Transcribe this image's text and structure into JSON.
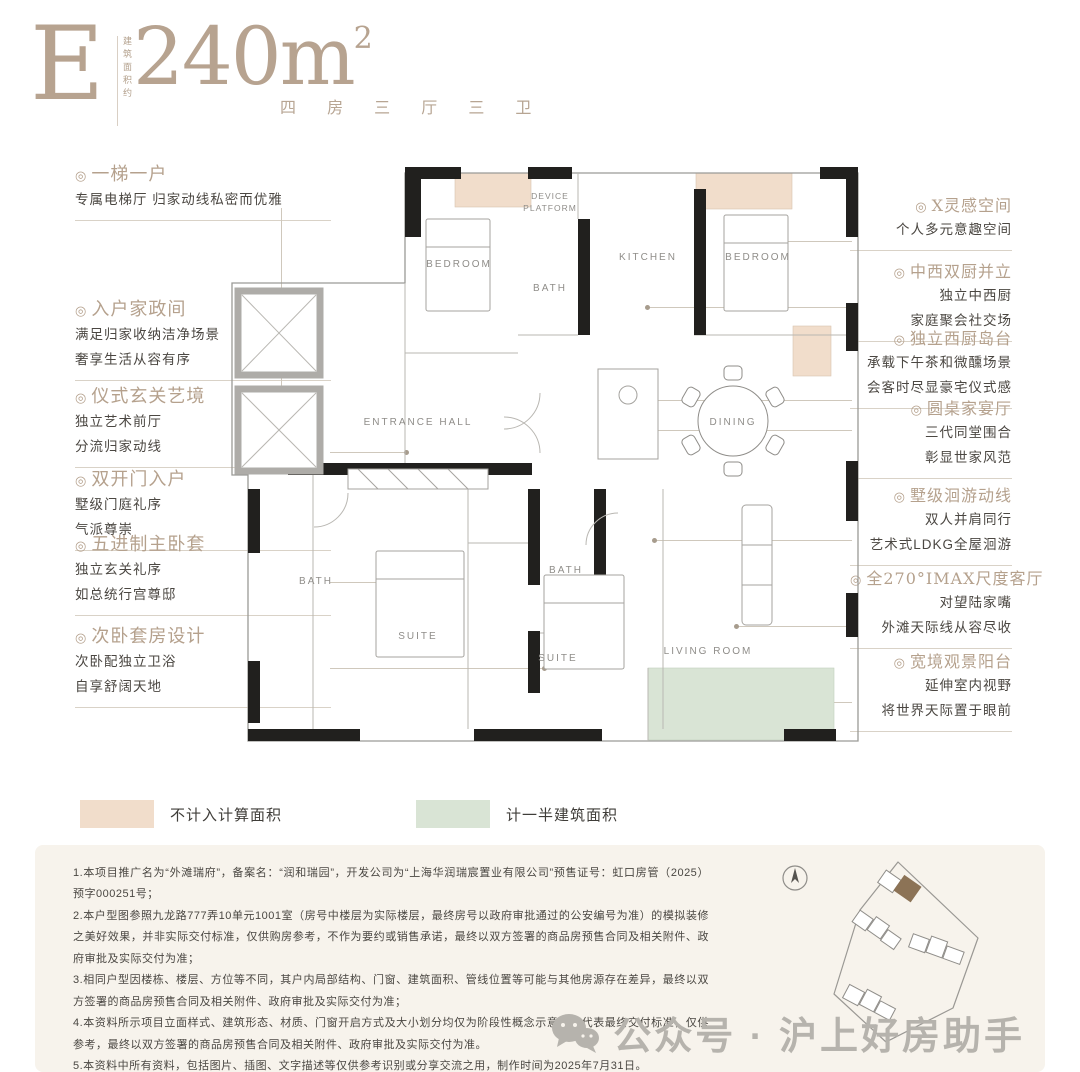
{
  "header": {
    "monogram": "E",
    "area_caption": "建筑面积约",
    "area_value": "240m",
    "area_sup": "2",
    "spec": "四 房 三 厅 三 卫"
  },
  "misc": {
    "bullet": "◎"
  },
  "left_annotations": [
    {
      "title": "一梯一户",
      "lines": [
        "专属电梯厅 归家动线私密而优雅"
      ]
    },
    {
      "title": "入户家政间",
      "lines": [
        "满足归家收纳洁净场景",
        "奢享生活从容有序"
      ]
    },
    {
      "title": "仪式玄关艺境",
      "lines": [
        "独立艺术前厅",
        "分流归家动线"
      ]
    },
    {
      "title": "双开门入户",
      "lines": [
        "墅级门庭礼序",
        "气派尊崇"
      ]
    },
    {
      "title": "五进制主卧套",
      "lines": [
        "独立玄关礼序",
        "如总统行宫尊邸"
      ]
    },
    {
      "title": "次卧套房设计",
      "lines": [
        "次卧配独立卫浴",
        "自享舒阔天地"
      ]
    }
  ],
  "right_annotations": [
    {
      "title": "X灵感空间",
      "lines": [
        "个人多元意趣空间"
      ]
    },
    {
      "title": "中西双厨并立",
      "lines": [
        "独立中西厨",
        "家庭聚会社交场"
      ]
    },
    {
      "title": "独立西厨岛台",
      "lines": [
        "承载下午茶和微醺场景",
        "会客时尽显豪宅仪式感"
      ]
    },
    {
      "title": "圆桌家宴厅",
      "lines": [
        "三代同堂围合",
        "彰显世家风范"
      ]
    },
    {
      "title": "墅级洄游动线",
      "lines": [
        "双人并肩同行",
        "艺术式LDKG全屋洄游"
      ]
    },
    {
      "title": "全270°IMAX尺度客厅",
      "lines": [
        "对望陆家嘴",
        "外滩天际线从容尽收"
      ]
    },
    {
      "title": "宽境观景阳台",
      "lines": [
        "延伸室内视野",
        "将世界天际置于眼前"
      ]
    }
  ],
  "floor_plan": {
    "bedroom_left": "BEDROOM",
    "device_platform_line1": "DEVICE",
    "device_platform_line2": "PLATFORM",
    "bath_top": "BATH",
    "kitchen": "KITCHEN",
    "bedroom_right": "BEDROOM",
    "entrance_hall": "ENTRANCE HALL",
    "dining": "DINING",
    "bath_left": "BATH",
    "suite_main": "SUITE",
    "bath_mid": "BATH",
    "suite_second": "SUITE",
    "living_room": "LIVING ROOM"
  },
  "legend": {
    "items": [
      {
        "label": "不计入计算面积",
        "color": "#f1ddcb"
      },
      {
        "label": "计一半建筑面积",
        "color": "#d9e4d5"
      }
    ]
  },
  "disclaimer": {
    "items": [
      "1.本项目推广名为“外滩瑞府”，备案名：“润和瑞园”，开发公司为“上海华润瑞宸置业有限公司”预售证号：虹口房管（2025）预字000251号；",
      "2.本户型图参照九龙路777弄10单元1001室（房号中楼层为实际楼层，最终房号以政府审批通过的公安编号为准）的模拟装修之美好效果，并非实际交付标准，仅供购房参考，不作为要约或销售承诺，最终以双方签署的商品房预售合同及相关附件、政府审批及实际交付为准；",
      "3.相同户型因楼栋、楼层、方位等不同，其户内局部结构、门窗、建筑面积、管线位置等可能与其他房源存在差异，最终以双方签署的商品房预售合同及相关附件、政府审批及实际交付为准；",
      "4.本资料所示项目立面样式、建筑形态、材质、门窗开启方式及大小划分均仅为阶段性概念示意，不代表最终交付标准，仅供参考，最终以双方签署的商品房预售合同及相关附件、政府审批及实际交付为准。",
      "5.本资料中所有资料，包括图片、插图、文字描述等仅供参考识别或分享交流之用，制作时间为2025年7月31日。"
    ]
  },
  "watermark": {
    "text": "公众号 · 沪上好房助手"
  },
  "colors": {
    "accent_tan": "#b7a390",
    "pink_zone": "#f1ddcb",
    "green_zone": "#d9e4d5",
    "wall_black": "#21201e",
    "text_dark": "#4b4742",
    "watermark_gray": "#b6b3ad",
    "site_highlight": "#8c7356"
  }
}
